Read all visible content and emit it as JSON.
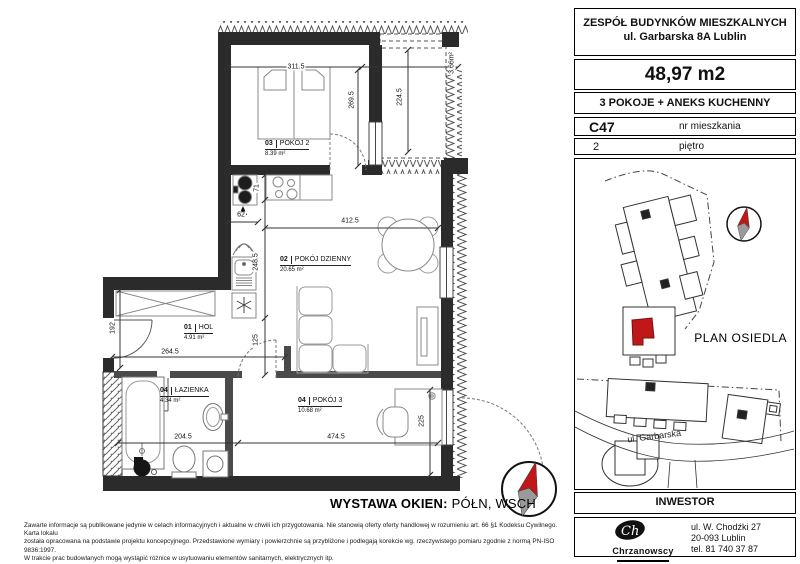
{
  "info_panel": {
    "project_title": "ZESPÓŁ BUDYNKÓW MIESZKALNYCH",
    "project_address": "ul. Garbarska 8A  Lublin",
    "area": "48,97 m2",
    "layout_type": "3 POKOJE  + ANEKS KUCHENNY",
    "apartment_number": "C47",
    "apartment_number_label": "nr mieszkania",
    "floor_number": "2",
    "floor_label": "piętro"
  },
  "site_plan": {
    "title": "PLAN OSIEDLA",
    "street_label": "ul. Garbarska"
  },
  "investor": {
    "section_title": "INWESTOR",
    "company_name": "Chrzanowscy",
    "address_line1": "ul. W. Chodźki 27",
    "address_line2": "20-093 Lublin",
    "phone": "tel. 81 740 37 87"
  },
  "floor_plan": {
    "rooms": [
      {
        "number": "03",
        "name": "POKÓJ 2",
        "area": "8.39 m²"
      },
      {
        "number": "02",
        "name": "POKÓJ DZIENNY",
        "area": "20.65 m²"
      },
      {
        "number": "01",
        "name": "HOL",
        "area": "4.91 m²"
      },
      {
        "number": "04",
        "name": "ŁAZIENKA",
        "area": "4.34 m²"
      },
      {
        "number": "04",
        "name": "POKÓJ 3",
        "area": "10.68 m²"
      }
    ],
    "balcony_area_label": "3.66m²",
    "dimensions": {
      "pokoj2_width": "311.5",
      "pokoj2_depth": "269.5",
      "balkon_depth": "224.5",
      "salon_width": "412.5",
      "aneks_counter_depth": "71",
      "aneks_width": "62",
      "kuchnia_depth": "248.5",
      "salon_left_depth": "125",
      "hol_left_depth": "192",
      "hol_width": "264.5",
      "lazienka_width": "204.5",
      "pokoj3_width": "474.5",
      "pokoj3_depth": "225"
    },
    "exposure_label": "WYSTAWA OKIEN:",
    "exposure_value": "PÓŁN, WSCH"
  },
  "footer": {
    "disclaimer_line1": "Zawarte informacje są publikowane jedynie w celach informacyjnych i aktualne w chwili ich przygotowania. Nie stanowią oferty oferty handlowej w rozumieniu art. 66 §1 Kodeksu Cywilnego. Karta lokalu",
    "disclaimer_line2": "została opracowana na podstawie projektu koncepcyjnego. Przedstawione wymiary i powierzchnie są przybliżone i podlegają korekcie wg. rzeczywistego pomiaru zgodnie z normą PN-ISO 9836:1997.",
    "disclaimer_line3": "W trakcie prac budowlanych mogą wystąpić różnice w usytuowaniu elementów sanitarnych, elektrycznych itp."
  },
  "colors": {
    "wall": "#2b2b2b",
    "highlight_red": "#c01818",
    "compass_gray": "#9a9a9a"
  }
}
